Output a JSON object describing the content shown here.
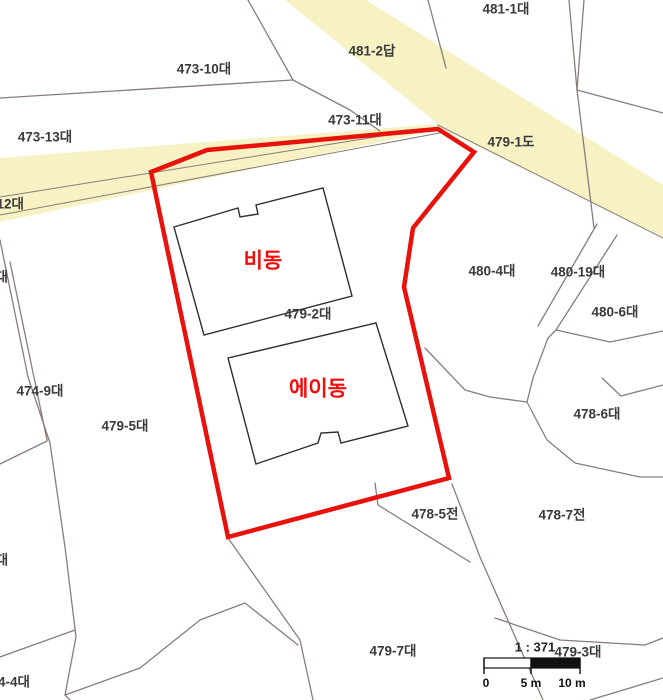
{
  "map": {
    "width": 663,
    "height": 700,
    "colors": {
      "background": "#ffffff",
      "road_fill": "#f6f2c4",
      "boundary_line": "#8a7c7a",
      "selection_stroke": "#e8120c",
      "building_stroke": "#2e2e2e",
      "building_fill": "#ffffff",
      "parcel_label": "#3a3a3a",
      "building_label": "#f20d0d",
      "scale_black": "#111111",
      "scale_white": "#ffffff"
    },
    "road_polygons": [
      {
        "name": "road-area",
        "points": "0,158 438,124 285,0 366,0 663,185 663,237 442,129 0,222"
      }
    ],
    "boundary_lines": [
      {
        "points": "248,0 293,80 350,110 380,131",
        "w": 1.3
      },
      {
        "points": "293,80 0,98",
        "w": 1.3
      },
      {
        "points": "0,240 28,377 50,443 65,547 76,637 65,695 70,700",
        "w": 1.3
      },
      {
        "points": "10,262 47,440",
        "w": 1.3
      },
      {
        "points": "47,441 0,464",
        "w": 1.3
      },
      {
        "points": "75,630 0,657",
        "w": 1.3
      },
      {
        "points": "65,695 140,668 200,620 245,603 298,645",
        "w": 1.3
      },
      {
        "points": "228,538 300,640 313,700",
        "w": 1.3
      },
      {
        "points": "375,483 378,505 470,562",
        "w": 1.3
      },
      {
        "points": "452,484 480,557 543,700",
        "w": 1.3
      },
      {
        "points": "425,348 465,390 490,397 527,402 533,378 548,338",
        "w": 1.3
      },
      {
        "points": "548,338 556,330 610,342 663,331",
        "w": 1.3
      },
      {
        "points": "527,402 547,440 575,463 640,477 663,477",
        "w": 1.3
      },
      {
        "points": "597,224 538,326",
        "w": 1.3
      },
      {
        "points": "617,235 556,330",
        "w": 1.3
      },
      {
        "points": "0,197 438,127",
        "w": 1.0
      },
      {
        "points": "0,215 445,132",
        "w": 1.0
      },
      {
        "points": "438,125 663,238",
        "w": 1.0
      },
      {
        "points": "428,0 446,68",
        "w": 1.3
      },
      {
        "points": "569,0 577,90",
        "w": 1.3
      },
      {
        "points": "584,0 577,90",
        "w": 1.3
      },
      {
        "points": "577,90 594,228",
        "w": 1.3
      },
      {
        "points": "577,90 663,113",
        "w": 1.3
      },
      {
        "points": "495,618 560,640 645,645 663,638",
        "w": 1.3
      },
      {
        "points": "590,700 663,678",
        "w": 1.3
      },
      {
        "points": "602,378 621,396 663,385",
        "w": 1.3
      }
    ],
    "selection_polygon": {
      "name": "selected-parcel-boundary",
      "points": "151,172 207,150 438,129 474,152 413,228 404,287 449,478 228,537",
      "stroke_width": 4.5
    },
    "buildings": [
      {
        "label": "비동",
        "label_x": 263,
        "label_y": 262,
        "points": "174,227 238,208 240,217 258,214 256,205 323,188 352,296 204,335"
      },
      {
        "label": "에이동",
        "label_x": 318,
        "label_y": 390,
        "points": "228,358 376,323 408,426 341,443 338,432 321,433 318,443 256,464"
      }
    ],
    "parcel_labels": [
      {
        "text": "481-1대",
        "x": 506,
        "y": 10
      },
      {
        "text": "481-2답",
        "x": 372,
        "y": 52
      },
      {
        "text": "473-10대",
        "x": 204,
        "y": 70
      },
      {
        "text": "473-13대",
        "x": 45,
        "y": 138
      },
      {
        "text": "473-11대",
        "x": 355,
        "y": 121
      },
      {
        "text": "479-1도",
        "x": 511,
        "y": 143
      },
      {
        "text": "-12대",
        "x": 8,
        "y": 205
      },
      {
        "text": "3대",
        "x": -2,
        "y": 278
      },
      {
        "text": "480-4대",
        "x": 492,
        "y": 272
      },
      {
        "text": "480-19대",
        "x": 578,
        "y": 273
      },
      {
        "text": "480-6대",
        "x": 615,
        "y": 313
      },
      {
        "text": "479-2대",
        "x": 308,
        "y": 315
      },
      {
        "text": "474-9대",
        "x": 40,
        "y": 392
      },
      {
        "text": "479-5대",
        "x": 125,
        "y": 427
      },
      {
        "text": "478-6대",
        "x": 597,
        "y": 415
      },
      {
        "text": "478-5전",
        "x": 435,
        "y": 515
      },
      {
        "text": "478-7전",
        "x": 562,
        "y": 516
      },
      {
        "text": "대",
        "x": 2,
        "y": 561
      },
      {
        "text": "4-4대",
        "x": 14,
        "y": 683
      },
      {
        "text": "479-7대",
        "x": 393,
        "y": 652
      },
      {
        "text": "479-3대",
        "x": 578,
        "y": 653
      }
    ],
    "scale_bar": {
      "ratio_label": "1 : 371",
      "ratio_x": 535,
      "ratio_y": 648,
      "x": 484,
      "y": 658,
      "width": 96,
      "height": 10,
      "mid_frac": 0.49,
      "tick_drop": 6,
      "ticks": [
        {
          "frac": 0.0,
          "label": "0",
          "lx": 486,
          "ly": 684
        },
        {
          "frac": 0.49,
          "label": "5 m",
          "lx": 531,
          "ly": 684
        },
        {
          "frac": 1.0,
          "label": "10 m",
          "lx": 572,
          "ly": 684
        }
      ]
    }
  }
}
